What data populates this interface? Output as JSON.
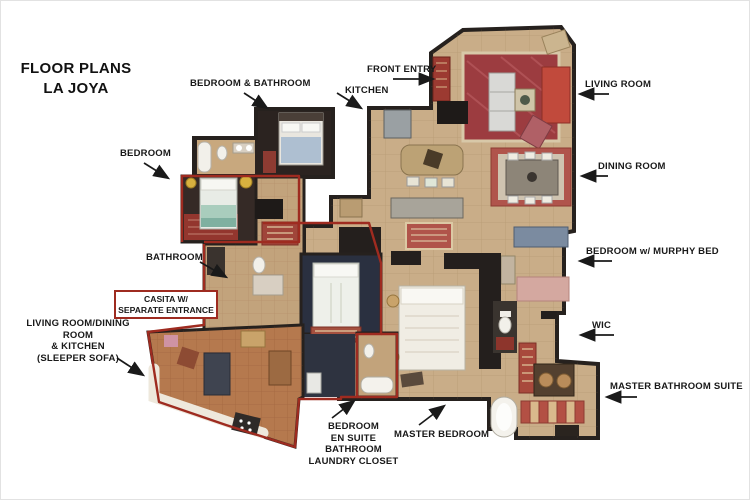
{
  "title": {
    "text": "FLOOR PLANS\nLA JOYA"
  },
  "labels": {
    "bedroom_bathroom": "BEDROOM & BATHROOM",
    "front_entry": "FRONT ENTRY",
    "kitchen": "KITCHEN",
    "living_room": "LIVING ROOM",
    "dining_room": "DINING ROOM",
    "bedroom_left": "BEDROOM",
    "bedroom_murphy": "BEDROOM w/ MURPHY BED",
    "bathroom": "BATHROOM",
    "wic": "WIC",
    "casita": "CASITA W/\nSEPARATE ENTRANCE",
    "casita_living": "LIVING ROOM/DINING ROOM\n& KITCHEN\n(SLEEPER SOFA)",
    "master_bathroom": "MASTER BATHROOM SUITE",
    "bedroom_ensuite": "BEDROOM\nEN SUITE BATHROOM\nLAUNDRY CLOSET",
    "master_bedroom": "MASTER BEDROOM"
  },
  "colors": {
    "label_text": "#191919",
    "casita_outline_red": "#9e2b20",
    "wall_dark": "#26211e",
    "main_floor_tan": "#c9ad88",
    "casita_floor_terracotta": "#b5794e",
    "living_room_rug_red": "#9c3c40"
  }
}
